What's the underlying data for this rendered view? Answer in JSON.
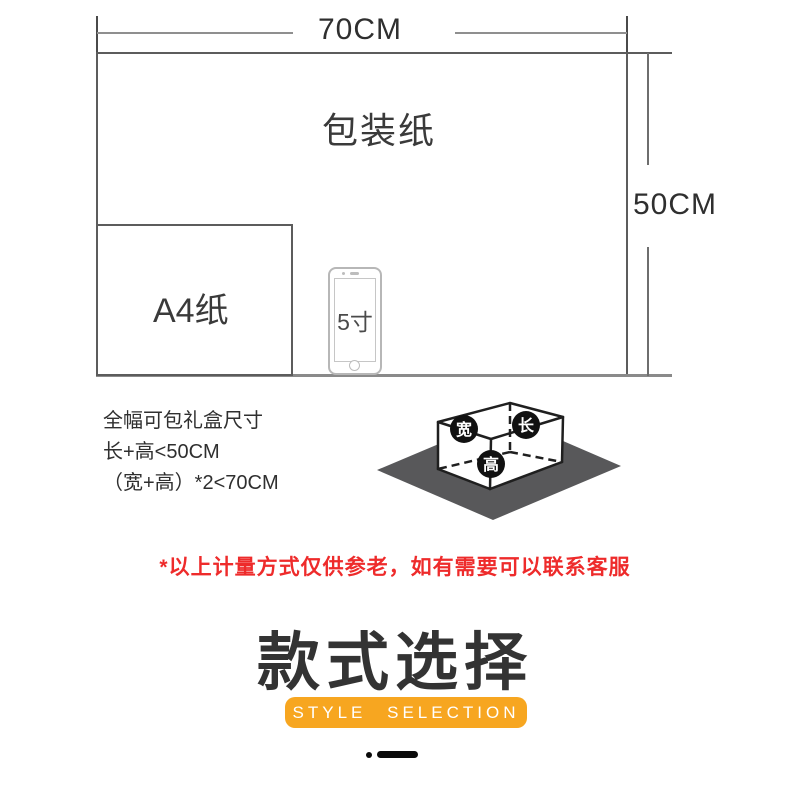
{
  "diagram": {
    "width_label": "70CM",
    "height_label": "50CM",
    "paper_label": "包装纸",
    "a4_label": "A4纸",
    "phone_label": "5寸"
  },
  "specs": {
    "lines": [
      "全幅可包礼盒尺寸",
      "长+高<50CM",
      "（宽+高）*2<70CM"
    ]
  },
  "box_diagram": {
    "width_badge": "宽",
    "length_badge": "长",
    "height_badge": "高",
    "badge_color": "#111111",
    "mat_color": "#58585a"
  },
  "note": {
    "text": "*以上计量方式仅供参老，如有需要可以联系客服",
    "color": "#EE2B2B"
  },
  "section": {
    "title": "款式选择",
    "subtitle": "STYLE SELECTION",
    "accent_color": "#F7A620"
  }
}
